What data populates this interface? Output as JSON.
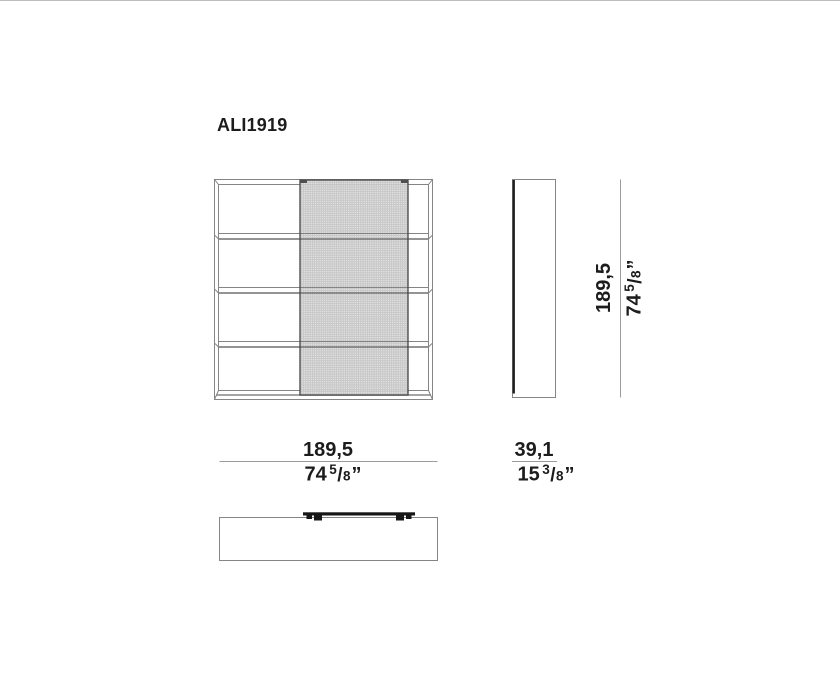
{
  "title": "ALI1919",
  "colors": {
    "line_gray": "#858585",
    "dim_gray": "#9c9c9c",
    "dark": "#161616",
    "panel_border": "#4f4f4f",
    "panel_fill": "#c4c4c4",
    "text": "#1c1c1c",
    "background": "#ffffff"
  },
  "dimensions": {
    "width": {
      "metric": "189,5",
      "imperial": {
        "whole": "74",
        "numerator": "5",
        "separator": "/",
        "denominator": "8",
        "unit": "”"
      }
    },
    "depth": {
      "metric": "39,1",
      "imperial": {
        "whole": "15",
        "numerator": "3",
        "separator": "/",
        "denominator": "8",
        "unit": "”"
      }
    },
    "height": {
      "metric": "189,5",
      "imperial": {
        "whole": "74",
        "numerator": "5",
        "separator": "/",
        "denominator": "8",
        "unit": "”"
      }
    }
  }
}
